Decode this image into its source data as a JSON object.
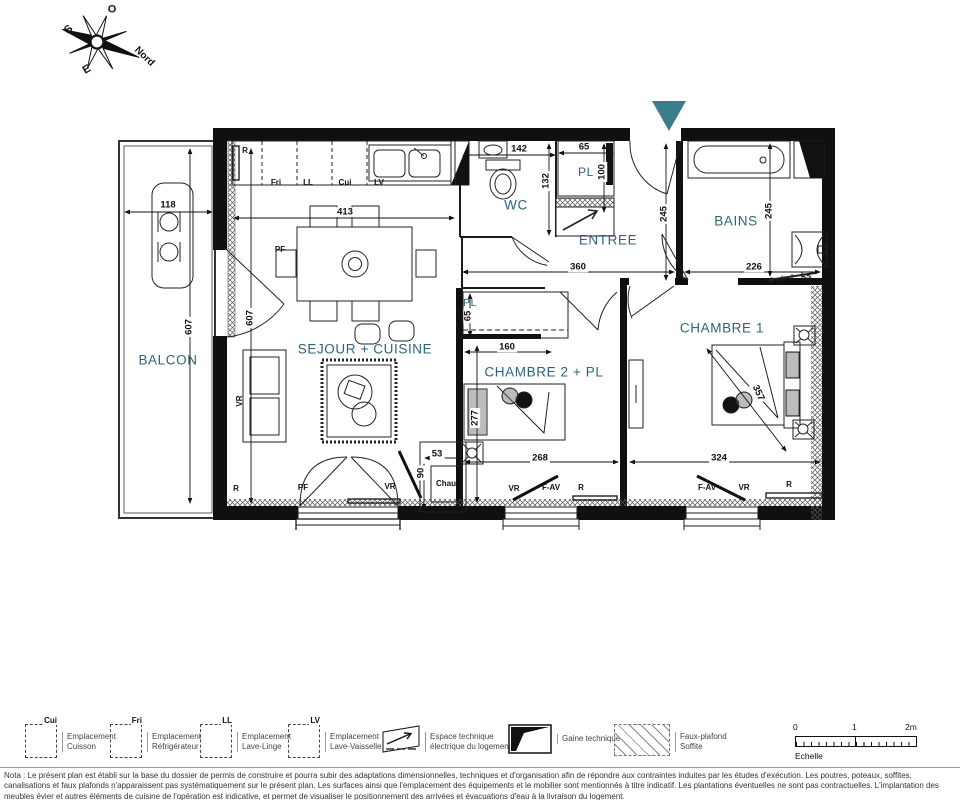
{
  "compass": {
    "north": "Nord",
    "south": "S",
    "east": "E",
    "west": "O"
  },
  "rooms": {
    "balcon": "BALCON",
    "sejour": "SEJOUR + CUISINE",
    "wc": "WC",
    "pl_entree": "PL",
    "entree": "ENTREE",
    "bains": "BAINS",
    "chambre1": "CHAMBRE 1",
    "chambre2": "CHAMBRE 2 + PL",
    "pl_chambre2": "PL"
  },
  "dims": {
    "balcon_width": "118",
    "sejour_width": "413",
    "wc_width": "142",
    "wc_depth": "132",
    "pl_width": "65",
    "pl_depth": "100",
    "entree_width": "360",
    "entree_depth": "245",
    "bains_depth": "245",
    "bains_width": "226",
    "balcon_height": "607",
    "sejour_height": "607",
    "pl2_depth": "65",
    "pl2_width": "160",
    "ch2_depth": "277",
    "ch2_width": "268",
    "ch1_width": "324",
    "ch1_diag": "357",
    "chau_width": "53",
    "chau_depth": "90"
  },
  "labels": {
    "fri": "Fri",
    "ll": "LL",
    "cui": "Cui",
    "lv": "LV",
    "r": "R",
    "pf": "PF",
    "vr": "VR",
    "fav": "F-AV",
    "ss": "SS",
    "chau": "Chau"
  },
  "legend": {
    "items": [
      {
        "tag": "Cui",
        "line1": "Emplacement",
        "line2": "Cuisson"
      },
      {
        "tag": "Fri",
        "line1": "Emplacement",
        "line2": "Réfrigérateur"
      },
      {
        "tag": "LL",
        "line1": "Emplacement",
        "line2": "Lave-Linge"
      },
      {
        "tag": "LV",
        "line1": "Emplacement",
        "line2": "Lave-Vaisselle"
      }
    ],
    "espace": {
      "line1": "Espace technique",
      "line2": "électrique du logement"
    },
    "gaine": "Gaine technique",
    "faux": {
      "line1": "Faux-plafond",
      "line2": "Soffite"
    },
    "scale": {
      "t0": "0",
      "t1": "1",
      "t2": "2m",
      "caption": "Echelle"
    }
  },
  "nota": "Nota : Le présent plan est établi sur la base du dossier de permis de construire et pourra subir des adaptations dimensionnelles, techniques et d'organisation afin de répondre aux contraintes induites par les études d'exécution. Les poutres, poteaux, soffites, canalisations et faux plafonds n'apparaissent pas systématiquement sur le présent plan. Les surfaces ainsi que l'emplacement des équipements et le mobilier sont mentionnés à titre indicatif. Les plantations éventuelles ne sont pas contractuelles. L'implantation des meubles évier et autres éléments de cuisine de l'opération est indicative, et permet de visualiser le positionnement des arrivées et évacuations d'eau à la livraison du logement."
}
